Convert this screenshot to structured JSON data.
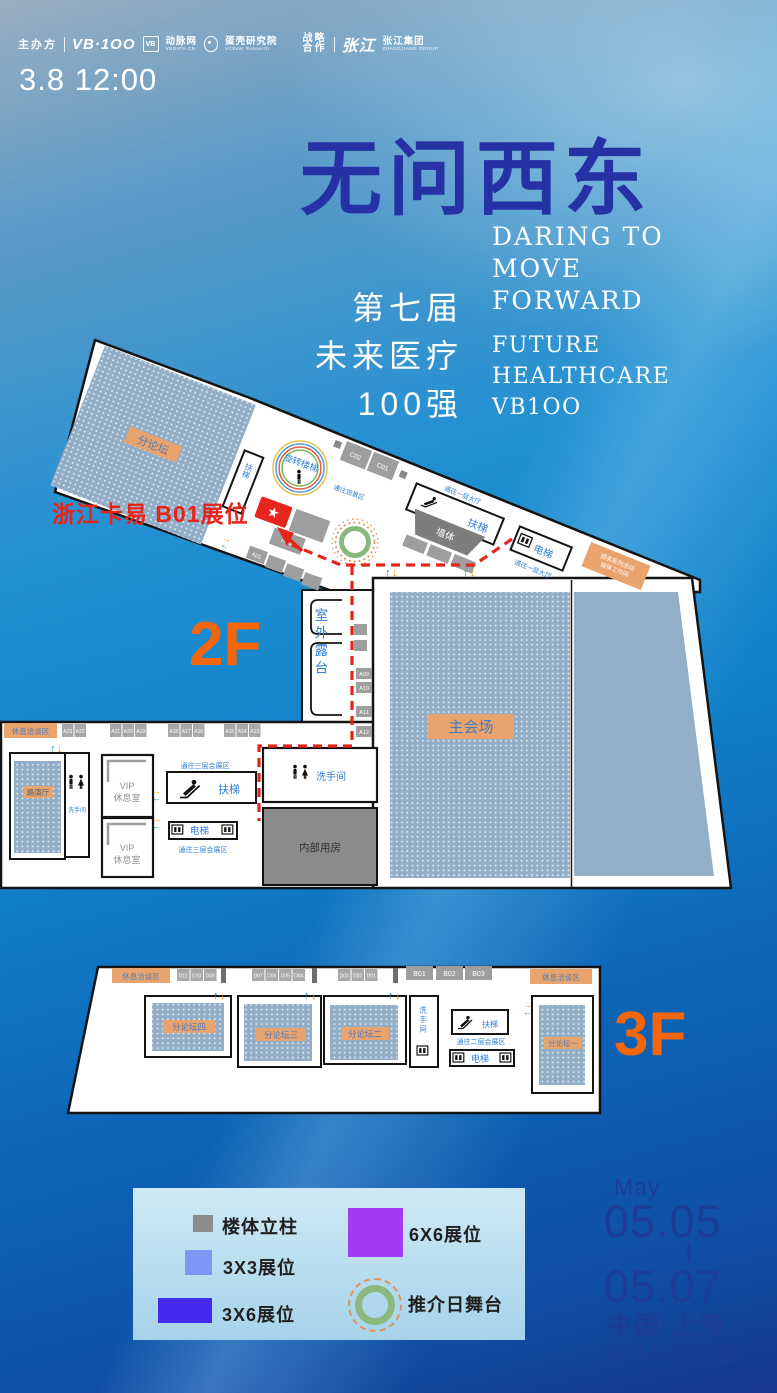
{
  "header": {
    "organizer_label": "主办方",
    "logo_vb100": "VB·1OO",
    "logo_vb_box": "VB",
    "logo_vcbeat": "动脉网",
    "logo_vcbeat_sub": "VBDATA.CN",
    "logo_eggshell": "蛋壳研究院",
    "logo_eggshell_sub": "VCBeat Research",
    "partner_label_1": "战略",
    "partner_label_2": "合作",
    "partner_logo": "张江",
    "partner_name": "张江集团",
    "partner_sub": "ZHANGJIANG GROUP",
    "timestamp": "3.8 12:00"
  },
  "title": {
    "cn": "无问西东",
    "en1": "DARING TO",
    "en2": "MOVE",
    "en3": "FORWARD",
    "sub1": "第七届",
    "sub2": "未来医疗",
    "sub3": "100强",
    "en_sub1": "FUTURE",
    "en_sub2": "HEALTHCARE",
    "en_sub3": "VB1OO"
  },
  "callout": {
    "text": "浙江卡易 B01展位"
  },
  "icons": {
    "star": "★",
    "up": "↑",
    "down": "↓",
    "right": "→",
    "left": "←"
  },
  "floor2": {
    "floor_label": "2F",
    "forum": "分论坛",
    "spiral_stairs": "旋转楼梯",
    "to_observation": "通往观景区",
    "escalator": "扶梯",
    "elevator": "电梯",
    "to_f1_hall_a": "通往一层大厅",
    "to_f1_hall_b": "通往一层大厅",
    "wall": "墙体",
    "media_tag_line1": "颁奖系列活动",
    "media_tag_line2": "媒体工作间",
    "booth_c": [
      "C02",
      "C01"
    ],
    "booth_a03": "A03",
    "booth_a01": "A01",
    "terrace": "室外露台",
    "main_hall": "主会场",
    "rest_area": "休息洽谈区",
    "booth_row_1": [
      "A23",
      "A22"
    ],
    "booth_row_2": [
      "A21",
      "A20",
      "A19"
    ],
    "booth_row_3": [
      "A18",
      "A17",
      "A16"
    ],
    "booth_row_4": [
      "A15",
      "A14",
      "A13"
    ],
    "side_booths": [
      "A09",
      "A10",
      "A11",
      "A12"
    ],
    "roadshow": "路演厅",
    "restroom": "洗手间",
    "restroom_center": "洗手间",
    "vip_line1": "VIP",
    "vip_line2": "休息室",
    "to_f3_expo_a": "通往三层会展区",
    "to_f3_expo_b": "通往三层会展区",
    "internal": "内部用房"
  },
  "floor3": {
    "floor_label": "3F",
    "rest_area_left": "休息洽谈区",
    "rest_area_right": "休息洽谈区",
    "small_booths_1": [
      "D11",
      "D10",
      "D09"
    ],
    "small_booths_2": [
      "D07",
      "D06",
      "D05",
      "D04"
    ],
    "small_booths_3": [
      "D03",
      "D02",
      "D01"
    ],
    "big_booths": [
      "B01",
      "B02",
      "B03"
    ],
    "forum_4": "分论坛四",
    "forum_3": "分论坛三",
    "forum_2": "分论坛二",
    "forum_1": "分论坛一",
    "restroom": "洗手间",
    "escalator": "扶梯",
    "elevator": "电梯",
    "to_f2_expo": "通往二层会展区"
  },
  "legend": {
    "items": [
      {
        "label": "楼体立柱",
        "color": "#8c8c8c",
        "type": "pillar"
      },
      {
        "label": "3X3展位",
        "color": "#7e97f3",
        "type": "booth-3x3"
      },
      {
        "label": "3X6展位",
        "color": "#4629ef",
        "type": "booth-3x6"
      },
      {
        "label": "6X6展位",
        "color": "#a43bf3",
        "type": "booth-6x6"
      },
      {
        "label": "推介日舞台",
        "color": "#8ab87e",
        "type": "stage-ring"
      }
    ]
  },
  "event": {
    "month": "May",
    "date_start": "05.05",
    "separator": "|",
    "date_end": "05.07",
    "city": "中国·上海",
    "venue": "张江科学会堂"
  },
  "colors": {
    "accent_orange": "#f4660c",
    "map_room_blue": "#93aec7",
    "tag_orange": "#e9a36d",
    "tag_text_blue": "#4a7cc0",
    "path_red": "#e5251c",
    "title_blue": "#2531a4",
    "date_blue": "#1c3c96"
  }
}
